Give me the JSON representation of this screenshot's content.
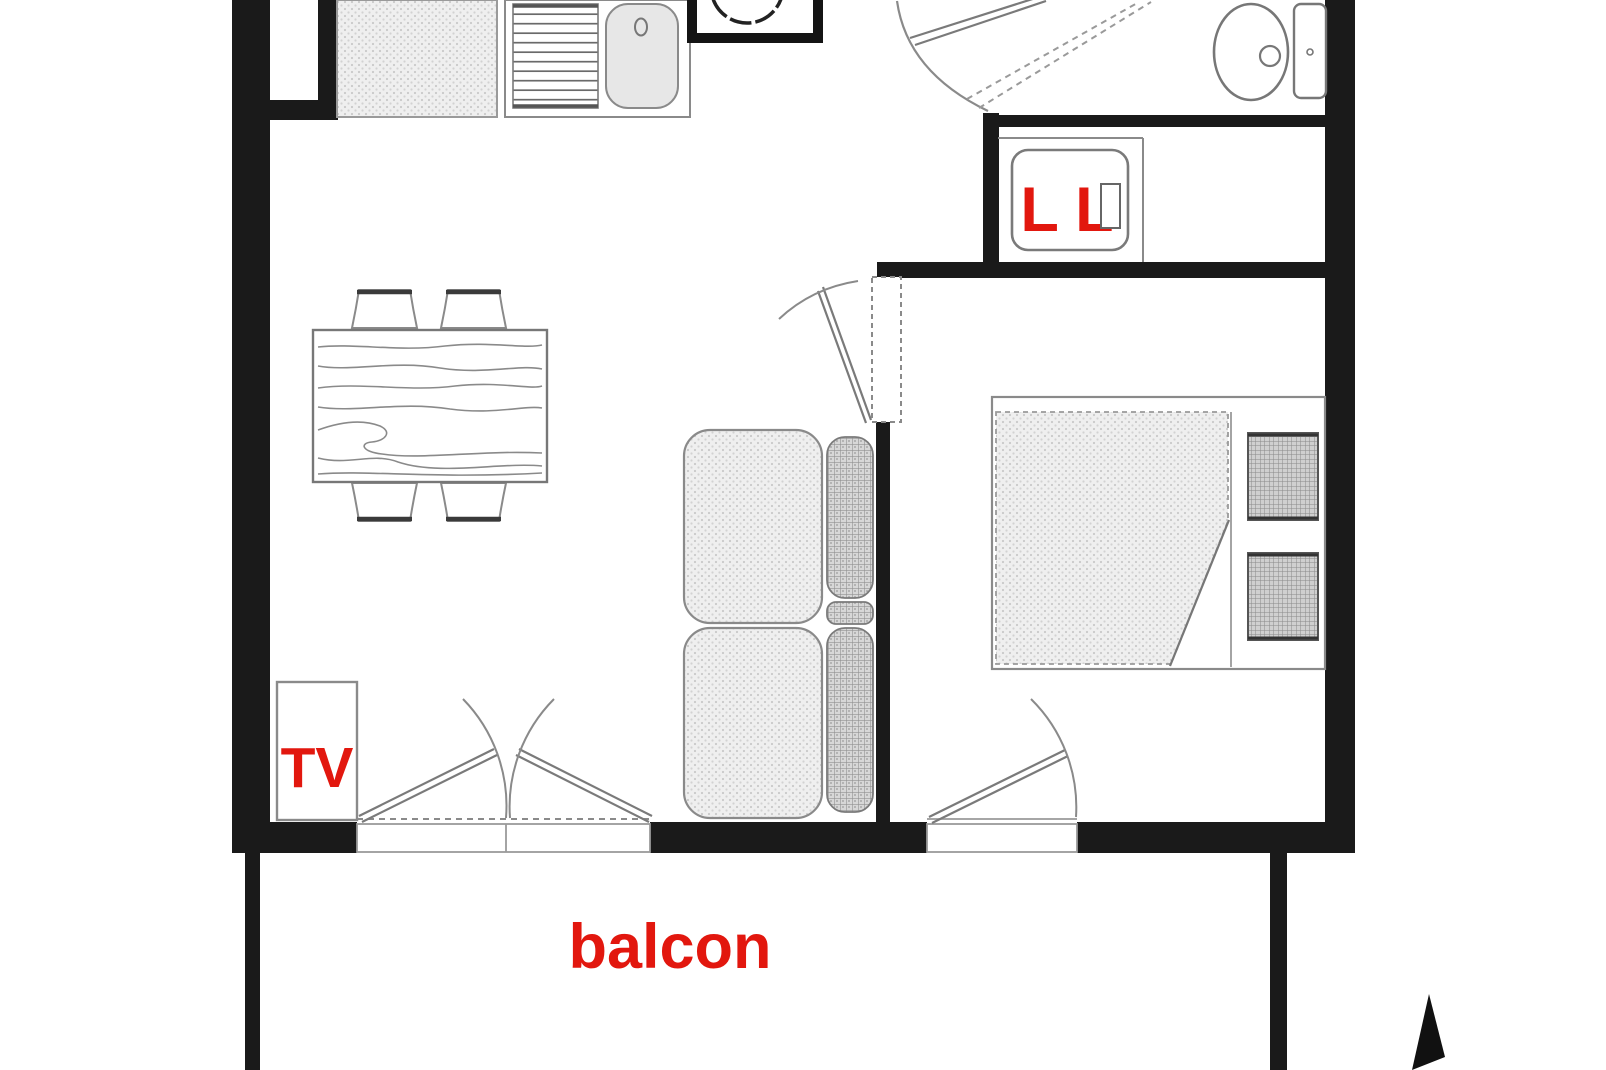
{
  "plan": {
    "labels": {
      "balcony": "balcon",
      "tv": "TV",
      "washing_machine": "L L"
    },
    "colors": {
      "wall": "#1a1a1a",
      "label_red": "#e2170e",
      "furniture_outline": "#7a7a7a",
      "fill_light": "#efefef",
      "fill_hatch": "#d6d6d6"
    }
  }
}
